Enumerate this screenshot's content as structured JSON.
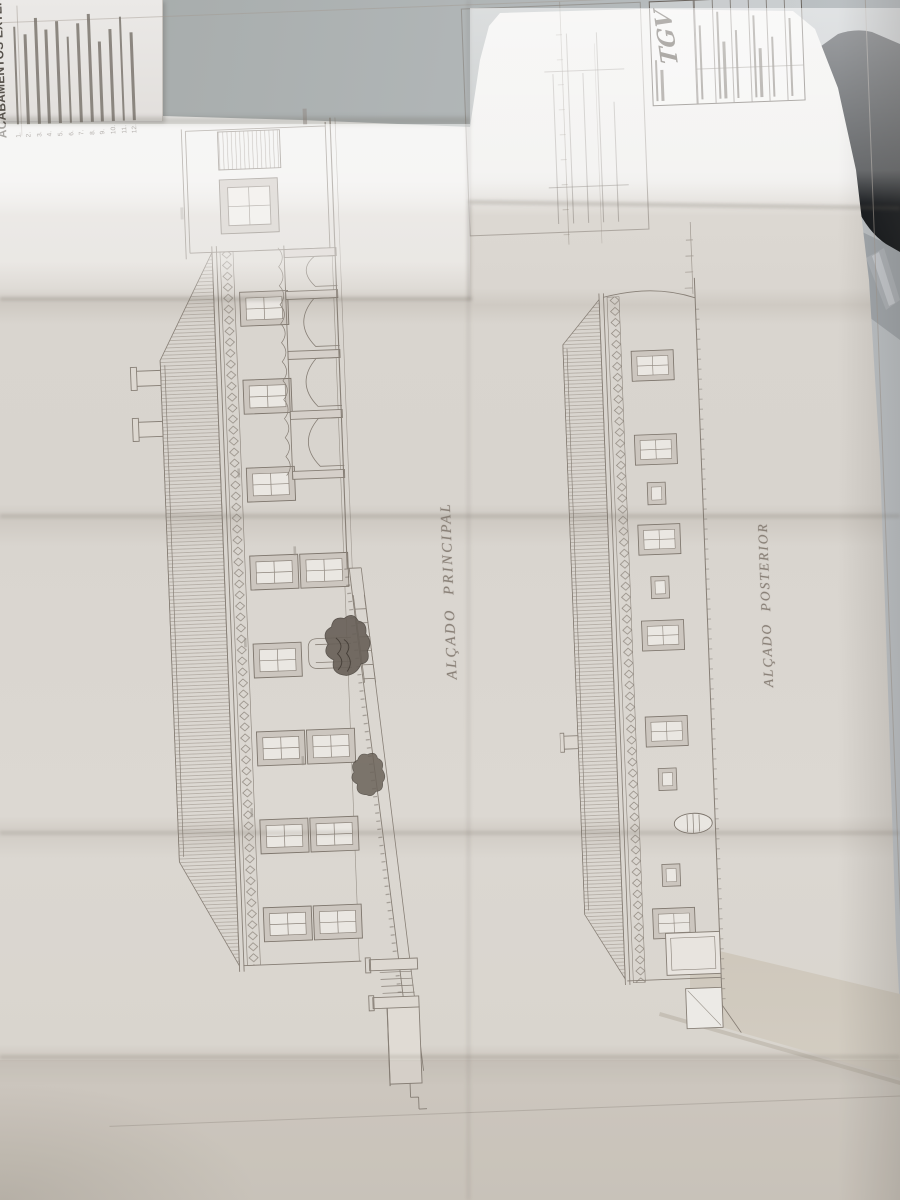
{
  "scene": {
    "wall_color": "#b1b6b7",
    "dark_object_color": "#1a1e23",
    "metal_edge_color": "#b0b5ba",
    "paper_bright_color": "#efeeec",
    "paper_shadow_color": "#d2ccc3",
    "ink_color": "#877f76"
  },
  "sheet": {
    "legend": {
      "title": "ACABAMENTOS EXTERIORES",
      "items": [
        {
          "num": "1."
        },
        {
          "num": "2."
        },
        {
          "num": "3."
        },
        {
          "num": "4."
        },
        {
          "num": "5."
        },
        {
          "num": "6."
        },
        {
          "num": "7."
        },
        {
          "num": "8."
        },
        {
          "num": "9."
        },
        {
          "num": "10."
        },
        {
          "num": "11."
        },
        {
          "num": "12."
        }
      ]
    },
    "elevations": [
      {
        "label": "ALÇADO PRINCIPAL"
      },
      {
        "label": "ALÇADO POSTERIOR"
      }
    ],
    "title_block": {
      "logo": "TGV"
    }
  }
}
